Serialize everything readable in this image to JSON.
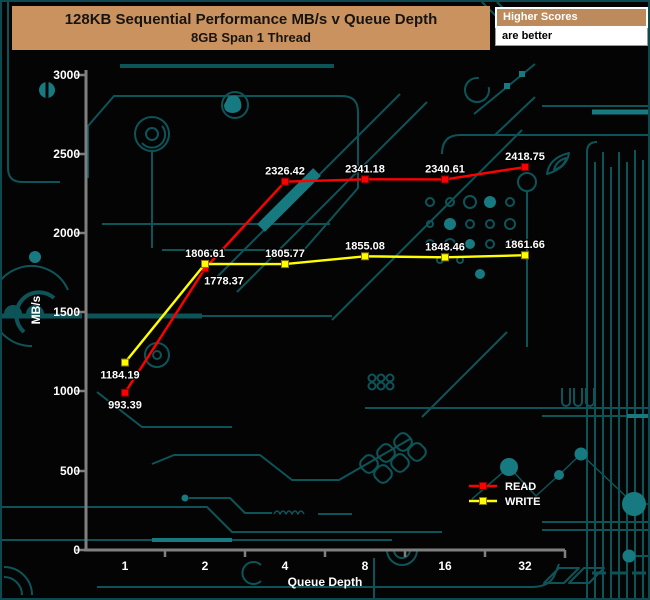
{
  "header": {
    "title": "128KB Sequential Performance MB/s v Queue Depth",
    "subtitle": "8GB Span 1 Thread",
    "note_title": "Higher Scores",
    "note_body": "are better"
  },
  "chart_data": {
    "type": "line",
    "title": "128KB Sequential Performance MB/s v Queue Depth",
    "subtitle": "8GB Span 1 Thread",
    "categories": [
      "1",
      "2",
      "4",
      "8",
      "16",
      "32"
    ],
    "xlabel": "Queue Depth",
    "ylabel": "MB/s",
    "ylim": [
      0,
      3000
    ],
    "y_ticks": [
      0,
      500,
      1000,
      1500,
      2000,
      2500,
      3000
    ],
    "grid": false,
    "legend_position": "inside-bottom-right",
    "marker": "square",
    "series": [
      {
        "name": "READ",
        "color": "#ff0000",
        "marker_border": "#7a0000",
        "values": [
          993.39,
          1778.37,
          2326.42,
          2341.18,
          2340.61,
          2418.75
        ]
      },
      {
        "name": "WRITE",
        "color": "#ffff00",
        "marker_border": "#8a7500",
        "values": [
          1184.19,
          1806.61,
          1805.77,
          1855.08,
          1848.46,
          1861.66
        ]
      }
    ]
  },
  "colors": {
    "background": "#040404",
    "header_bg": "#c9925f",
    "axis": "#7f7f7f",
    "label_text": "#ffffff",
    "circuit_trace": "#0d5459",
    "circuit_bright": "#177a81"
  }
}
